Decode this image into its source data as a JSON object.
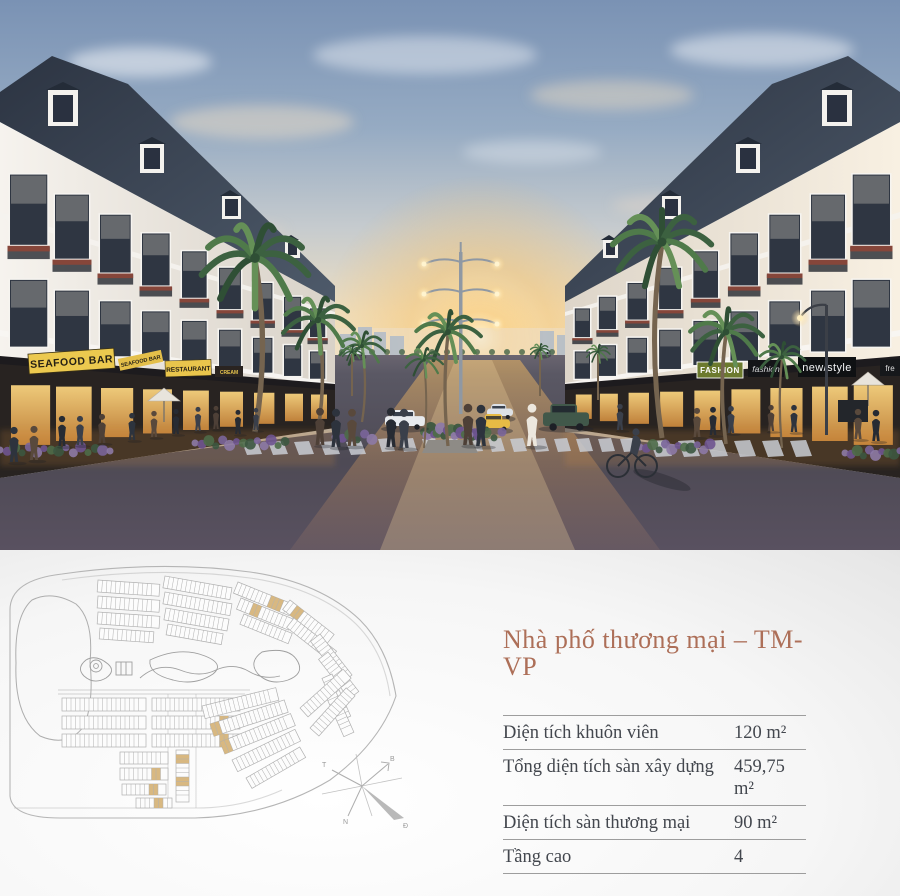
{
  "hero": {
    "signs": {
      "seafood_bar": "SEAFOOD BAR",
      "seafood_bar_awning": "SEAFOOD BAR",
      "restaurant": "RESTAURANT",
      "cream": "CREAM",
      "fashion": "FASHION",
      "fashion_script": "fashion",
      "new_style": "new/style",
      "fre": "fre"
    }
  },
  "site_plan": {
    "highlight_color": "#d6b47a",
    "compass": {
      "north_label": "B",
      "west_label": "T",
      "south_label": "N",
      "east_label": "Đ"
    }
  },
  "info_panel": {
    "title": "Nhà phố thương mại – TM-VP",
    "title_color": "#ad6f58",
    "rows": [
      {
        "label": "Diện tích khuôn viên",
        "value": "120 m²"
      },
      {
        "label": "Tổng diện tích sàn xây dựng",
        "value": "459,75 m²"
      },
      {
        "label": "Diện tích sàn thương mại",
        "value": "90 m²"
      },
      {
        "label": "Tầng cao",
        "value": "4"
      }
    ]
  }
}
